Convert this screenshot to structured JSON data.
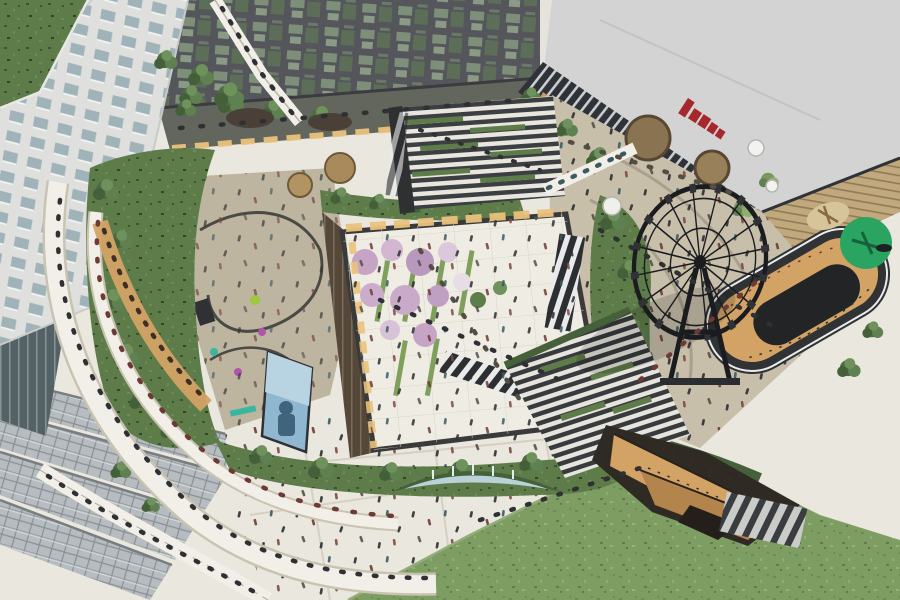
{
  "meta": {
    "description": "Bird's-eye architectural rendering of a mixed-use retail complex: sunken garden courtyard with blossom trees, rooftop park with playground, planted amphitheater steps, black observation wheel, oval atrium, crescent fountain, sloping lawn and crowds of tiny visitors.",
    "view": "aerial 3D render"
  },
  "palette": {
    "plaza_white": "#eae7df",
    "plaza_tan": "#c7bfaa",
    "terrace_dark": "#63665c",
    "tower_facade": "#dfe0de",
    "tower_glass": "#9fb3b8",
    "office_dark": "#54565c",
    "cinema_roof": "#d2d3d2",
    "cinema_band": "#2f3236",
    "cinema_sign_red": "#a5282c",
    "cinema_tan": "#c2a87d",
    "green_roof": "#5e7c49",
    "lawn": "#7e9d63",
    "tree_green": "#4d6c41",
    "blossom_pink": "#c5a4c6",
    "blossom_light": "#dcc8db",
    "courtyard_floor": "#efece4",
    "interior_amber": "#d2a365",
    "interior_glow": "#e9c27c",
    "wheel_black": "#1b1c1f",
    "water": "#b9d2d8",
    "screen_blue": "#8fb7cf",
    "accent_lime": "#9cc93e",
    "accent_magenta": "#b054ae",
    "accent_teal": "#3ab5a0",
    "play_mat": "#2aa461",
    "bridge_white": "#f1efe8",
    "hedge_dark": "#46613a"
  },
  "regions": {
    "tower": {
      "label": "Residential tower with rooftop lawn"
    },
    "office": {
      "label": "Glass-clad office block"
    },
    "cinema": {
      "label": "Event hall with red signage band"
    },
    "courtyard": {
      "label": "Sunken garden courtyard with blossom trees"
    },
    "amphitheater": {
      "label": "Planted amphitheater steps"
    },
    "wheel": {
      "label": "Observation wheel"
    },
    "rooftop_park": {
      "label": "Rooftop park greenery"
    },
    "playground": {
      "label": "Playground terrace"
    },
    "oval_atrium": {
      "label": "Oval atrium to lower retail levels"
    },
    "lawn": {
      "label": "Sloping event lawn"
    },
    "fountain": {
      "label": "Crescent fountain with hedge"
    },
    "retail_cut": {
      "label": "Open-air retail stair entrance"
    },
    "canopy": {
      "label": "Glazed canopy roofs"
    },
    "bridges": {
      "label": "Pedestrian bridges and ramps"
    },
    "plaza": {
      "label": "Ground-level plaza"
    }
  }
}
